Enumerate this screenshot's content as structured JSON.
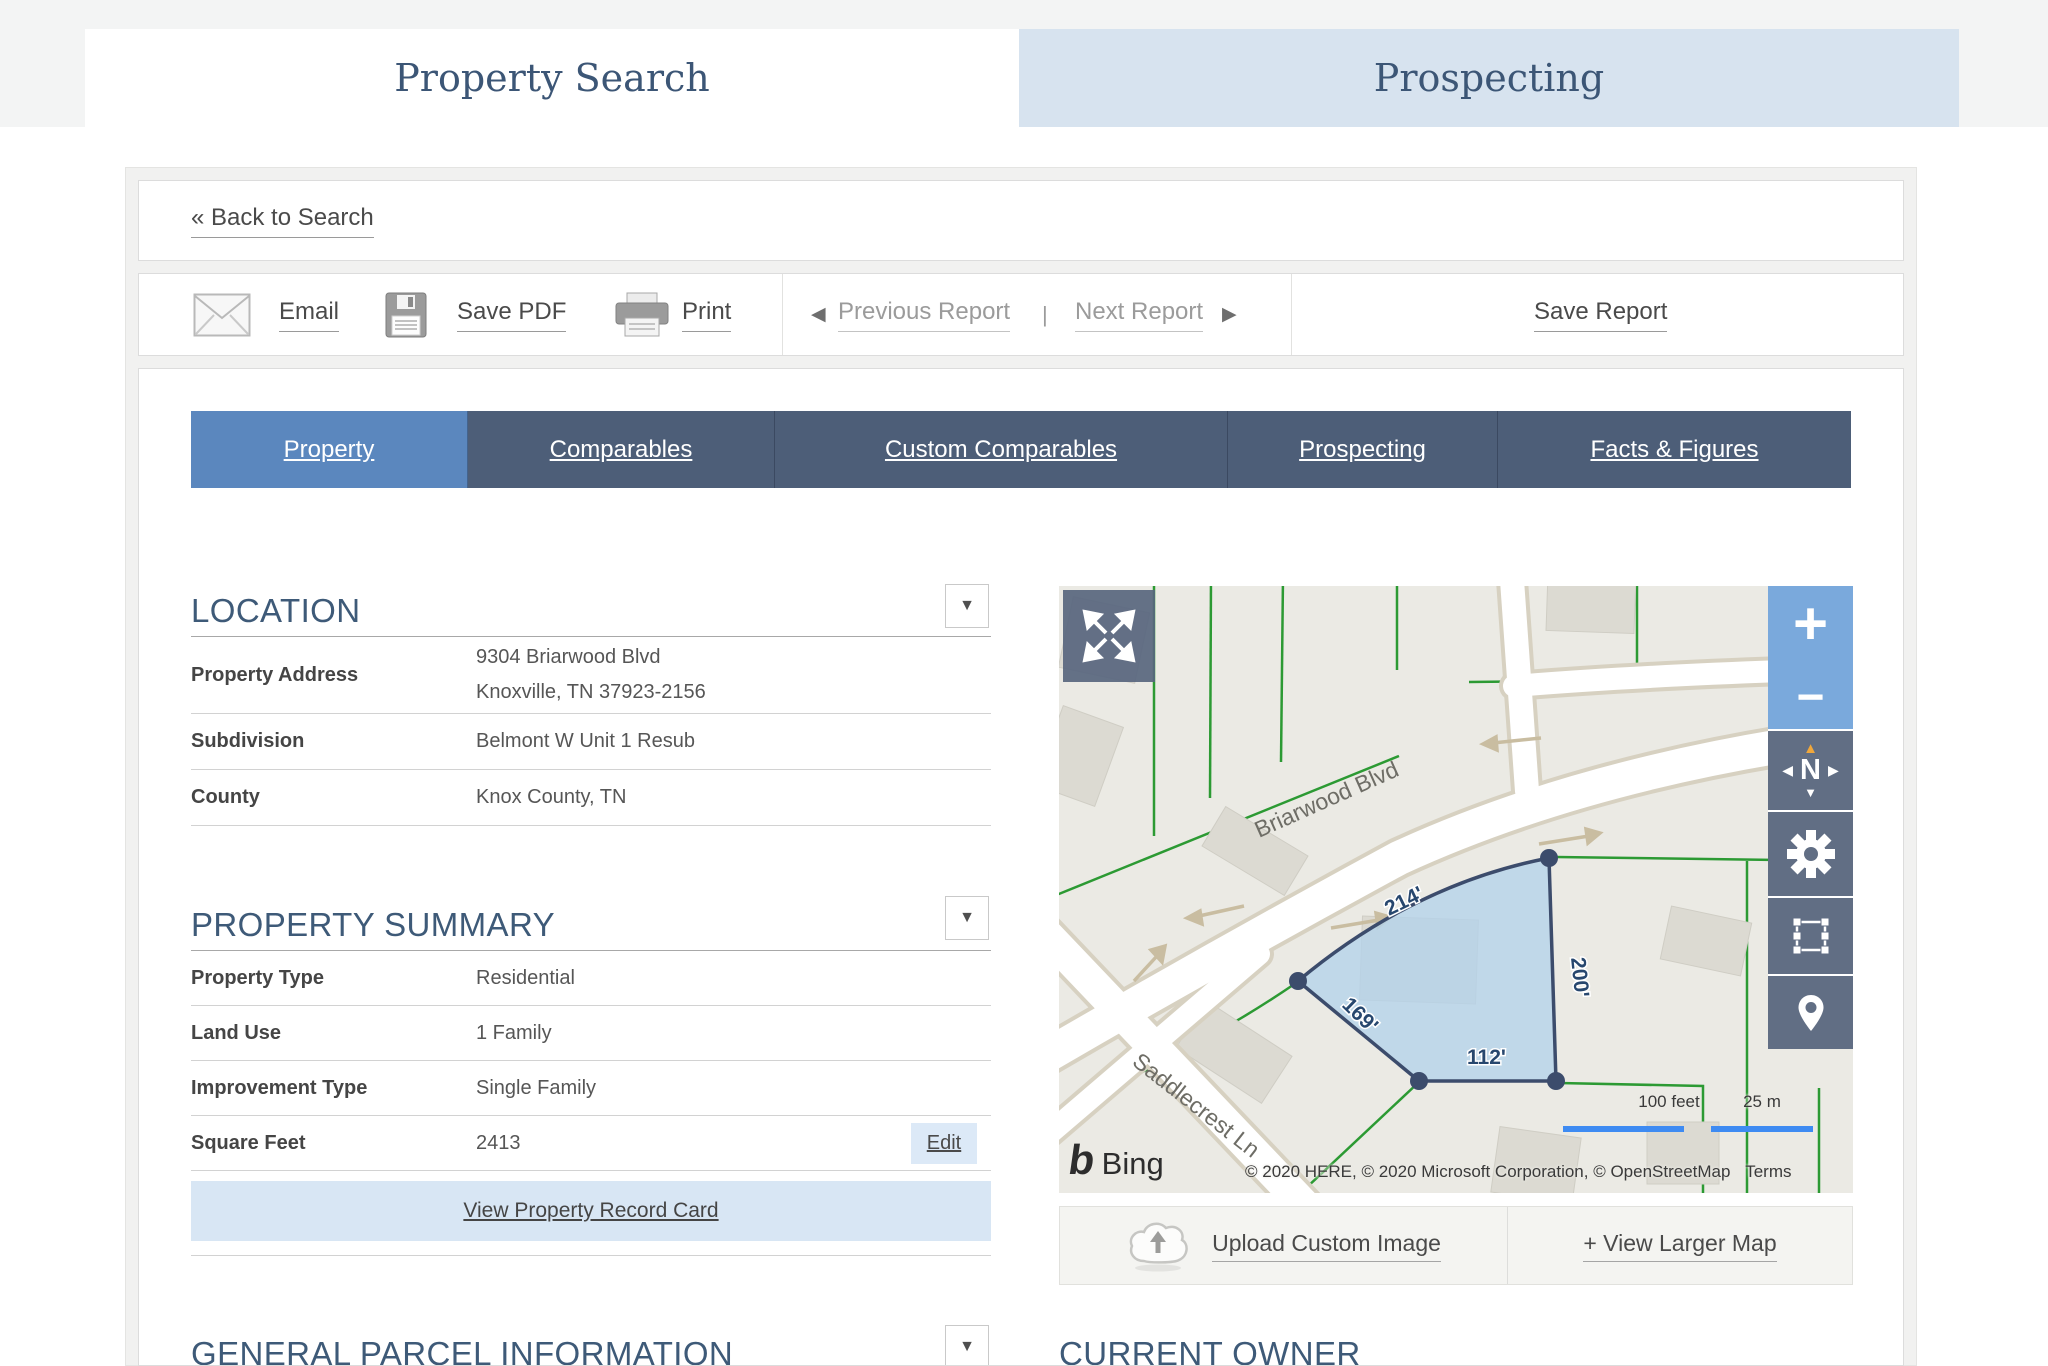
{
  "header": {
    "tabs": [
      {
        "label": "Property Search",
        "active": true
      },
      {
        "label": "Prospecting",
        "active": false
      }
    ]
  },
  "back_link": {
    "label": "« Back to Search"
  },
  "toolbar": {
    "email": "Email",
    "save_pdf": "Save PDF",
    "print": "Print",
    "previous": "Previous Report",
    "divider": "|",
    "next": "Next Report",
    "save_report": "Save Report"
  },
  "nav_tabs": [
    {
      "label": "Property",
      "active": true
    },
    {
      "label": "Comparables",
      "active": false
    },
    {
      "label": "Custom Comparables",
      "active": false
    },
    {
      "label": "Prospecting",
      "active": false
    },
    {
      "label": "Facts & Figures",
      "active": false
    }
  ],
  "location": {
    "title": "LOCATION",
    "rows": [
      {
        "label": "Property Address",
        "line1": "9304 Briarwood Blvd",
        "line2": "Knoxville, TN 37923-2156"
      },
      {
        "label": "Subdivision",
        "value": "Belmont W Unit 1 Resub"
      },
      {
        "label": "County",
        "value": "Knox County, TN"
      }
    ]
  },
  "property_summary": {
    "title": "PROPERTY SUMMARY",
    "rows": [
      {
        "label": "Property Type",
        "value": "Residential"
      },
      {
        "label": "Land Use",
        "value": "1 Family"
      },
      {
        "label": "Improvement Type",
        "value": "Single Family"
      },
      {
        "label": "Square Feet",
        "value": "2413"
      }
    ],
    "edit_button": "Edit",
    "record_card_link": "View Property Record Card"
  },
  "general_parcel": {
    "title": "GENERAL PARCEL INFORMATION"
  },
  "current_owner": {
    "title": "CURRENT OWNER"
  },
  "map": {
    "streets": {
      "briarwood": "Briarwood Blvd",
      "saddlecrest": "Saddlecrest Ln"
    },
    "dimensions": {
      "top": "214'",
      "right": "200'",
      "left": "169'",
      "bottom": "112'"
    },
    "controls": {
      "zoom_in": "+",
      "zoom_out": "−",
      "compass_n": "N"
    },
    "scale": {
      "feet": "100 feet",
      "meters": "25 m"
    },
    "logo": "Bing",
    "logo_mark": "b",
    "attribution": "© 2020 HERE, © 2020 Microsoft Corporation, © OpenStreetMap",
    "terms": "Terms",
    "upload_button": "Upload Custom Image",
    "larger_map_link": "+ View Larger Map"
  }
}
